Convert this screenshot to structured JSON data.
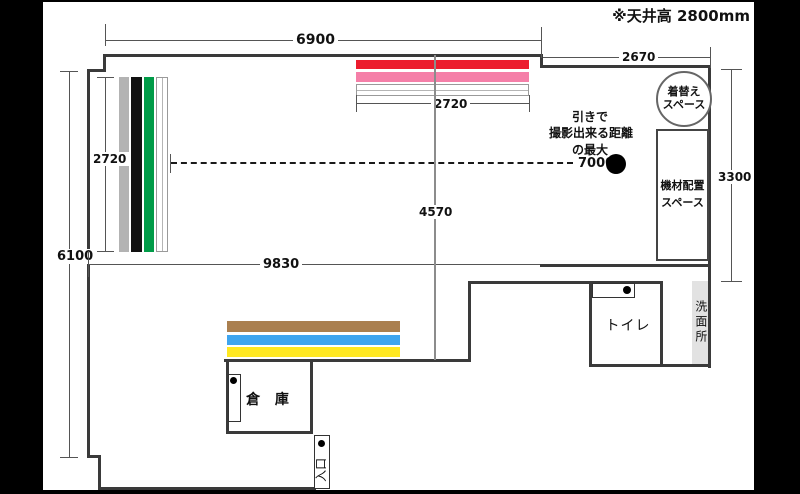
{
  "title": "※天井高 2800mm",
  "dims": {
    "top": "6900",
    "top_right": "2670",
    "backdrop_top": "2720",
    "backdrop_left": "2720",
    "left": "6100",
    "width_total": "9830",
    "center_vertical": "4570",
    "right": "3300",
    "shooting_distance": "7000"
  },
  "note": {
    "line1": "引きで",
    "line2": "撮影出来る距離",
    "line3": "の最大"
  },
  "rooms": {
    "changing1": "着替え",
    "changing2": "スペース",
    "equipment1": "機材配置",
    "equipment2": "スペース",
    "washroom": "洗面所",
    "toilet": "トイレ",
    "storage": "倉 庫",
    "entrance": "入口"
  },
  "colors": {
    "wall": "#3a3a3a",
    "backdrop_red": "#ec1c2e",
    "backdrop_pink": "#f57fa8",
    "backdrop_gray": "#b3b3b3",
    "backdrop_black": "#111111",
    "backdrop_green": "#009b48",
    "backdrop_brown": "#aa7f4f",
    "backdrop_blue": "#3fa5ef",
    "backdrop_yellow": "#ffe821",
    "washroom_bg": "#e2e2e2"
  }
}
